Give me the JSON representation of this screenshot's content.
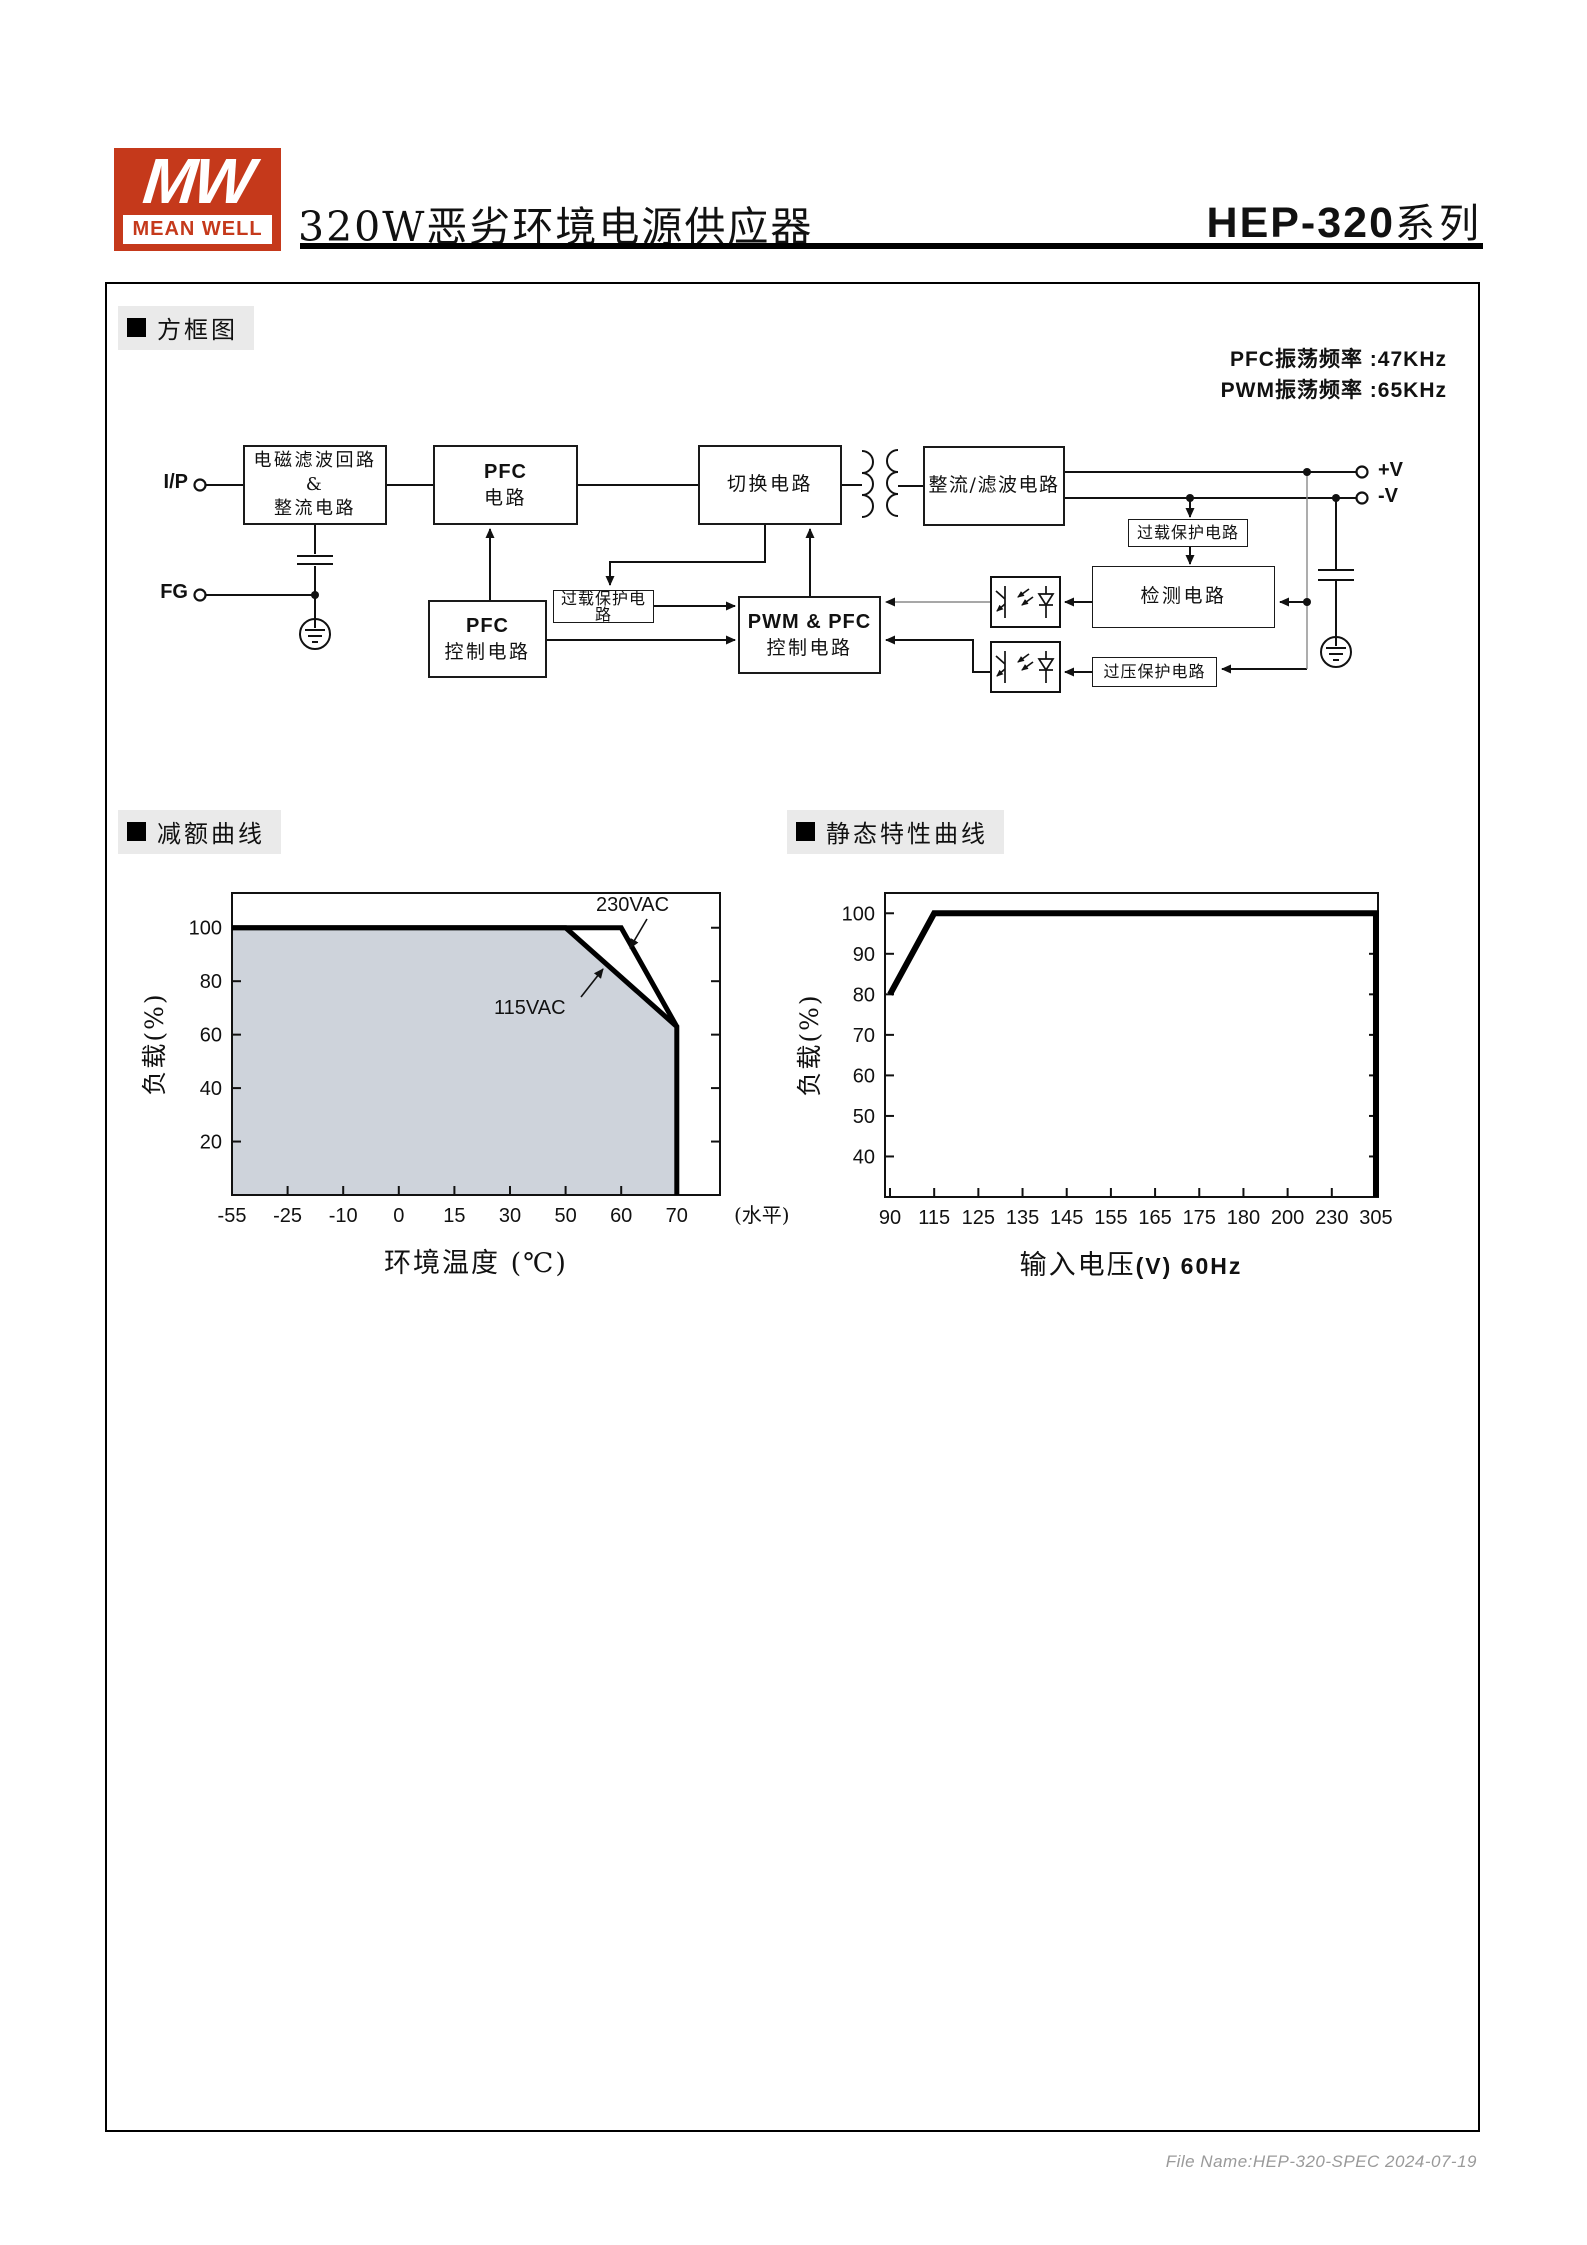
{
  "header": {
    "logo_mw": "MW",
    "logo_name": "MEAN WELL",
    "title": "320W恶劣环境电源供应器",
    "series_code": "HEP-320",
    "series_suffix": "系列"
  },
  "sections": {
    "block_diagram": "方框图",
    "derating": "减额曲线",
    "static_characteristic": "静态特性曲线"
  },
  "diagram": {
    "freq": [
      "PFC振荡频率 :47KHz",
      "PWM振荡频率 :65KHz"
    ],
    "terminals": {
      "input": "I/P",
      "fg": "FG",
      "vplus": "+V",
      "vminus": "-V"
    },
    "boxes": {
      "emi": [
        "电磁滤波回路",
        "&",
        "整流电路"
      ],
      "pfc": [
        "PFC",
        "电路"
      ],
      "switching": "切换电路",
      "rectifier": "整流/滤波电路",
      "overload1": "过载保护电路",
      "pfc_control": [
        "PFC",
        "控制电路"
      ],
      "pwm_control": [
        "PWM & PFC",
        "控制电路"
      ],
      "overload2": "过载保护电路",
      "detection": "检测电路",
      "overvoltage": "过压保护电路"
    }
  },
  "chart_data": [
    {
      "type": "area",
      "title": "减额曲线",
      "xlabel": "环境温度 (℃)",
      "ylabel": "负载(%)",
      "x_axis_note": "(水平)",
      "xscale": "categorical-even",
      "grid": false,
      "x_ticks": [
        -55,
        -25,
        -10,
        0,
        15,
        30,
        50,
        60,
        70
      ],
      "y_ticks": [
        100,
        80,
        60,
        40,
        20
      ],
      "ylim": [
        0,
        113
      ],
      "fill_color": "#ced3db",
      "series": [
        {
          "name": "230VAC",
          "points": [
            [
              -55,
              100
            ],
            [
              60,
              100
            ],
            [
              70,
              63
            ]
          ]
        },
        {
          "name": "115VAC",
          "points": [
            [
              -55,
              100
            ],
            [
              50,
              100
            ],
            [
              70,
              63
            ],
            [
              70,
              0
            ]
          ],
          "fill": true
        }
      ]
    },
    {
      "type": "line",
      "title": "静态特性曲线",
      "xlabel": "输入电压",
      "xlabel_suffix": "(V) 60Hz",
      "ylabel": "负载(%)",
      "xscale": "categorical-even",
      "grid": false,
      "x_ticks": [
        90,
        115,
        125,
        135,
        145,
        155,
        165,
        175,
        180,
        200,
        230,
        305
      ],
      "y_ticks": [
        100,
        90,
        80,
        70,
        60,
        50,
        40
      ],
      "ylim": [
        30,
        105
      ],
      "series": [
        {
          "name": "load",
          "points": [
            [
              90,
              80
            ],
            [
              115,
              100
            ],
            [
              305,
              100
            ],
            [
              305,
              0
            ]
          ]
        }
      ]
    }
  ],
  "footer": {
    "file_name": "File Name:HEP-320-SPEC 2024-07-19"
  },
  "colors": {
    "brand_red": "#c5391b",
    "section_label_bg": "#eaeaea",
    "chart_fill": "#ced3db",
    "footer_text": "#9a9a9a"
  }
}
